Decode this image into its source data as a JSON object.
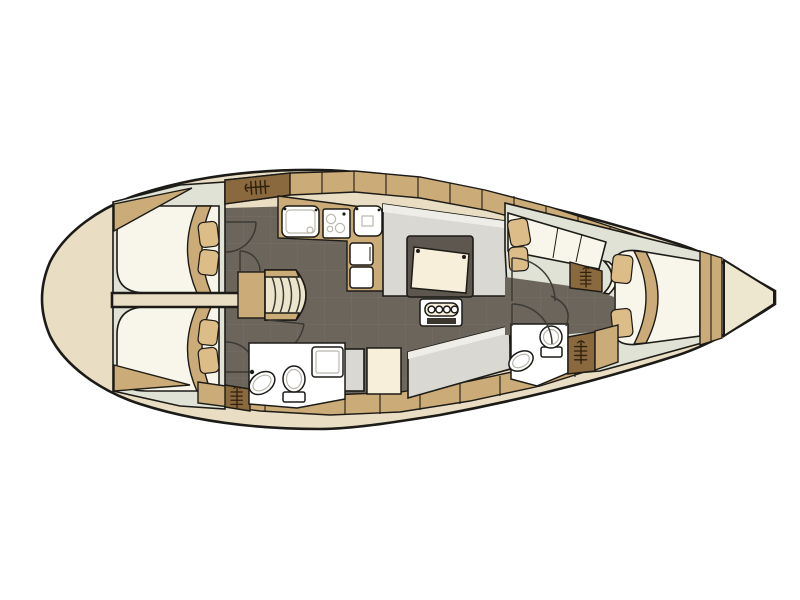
{
  "title": "sailboat-interior-floor-plan",
  "canvas": {
    "width": 800,
    "height": 600
  },
  "palette": {
    "page": "#ffffff",
    "hull": "#e9dec3",
    "deck": "#eee7d0",
    "line": "#1d1b17",
    "inner_line": "#b9b7ac",
    "wall": "#3c3a35",
    "sage": "#dfe2d4",
    "floor": "#6c655c",
    "floor_grid": "#7e7669",
    "tan": "#cbab77",
    "wardrobe": "#8a693f",
    "icon": "#30200c",
    "bed": "#f8f5ea",
    "pillow": "#dcbd87",
    "settee": "#d9d8d3",
    "settee_light": "#eeede7",
    "white": "#ffffff",
    "cream": "#f7efd9",
    "table_frame": "#5d5750",
    "slot": "#3b372f",
    "step": "#ece4cb"
  },
  "areas": [
    {
      "name": "swim-platform"
    },
    {
      "name": "aft-cabin-port"
    },
    {
      "name": "aft-cabin-starboard"
    },
    {
      "name": "companionway-steps"
    },
    {
      "name": "galley"
    },
    {
      "name": "aft-head"
    },
    {
      "name": "salon"
    },
    {
      "name": "nav-area"
    },
    {
      "name": "forward-head"
    },
    {
      "name": "forward-cabin"
    },
    {
      "name": "bow-anchor-locker"
    }
  ],
  "fixtures": {
    "hanging_lockers": 4,
    "sinks": 4,
    "toilets": 2,
    "showers": 1,
    "stove_burners": 3,
    "double_berths": 3,
    "settees": 3,
    "table_bottle_slots": 4
  }
}
